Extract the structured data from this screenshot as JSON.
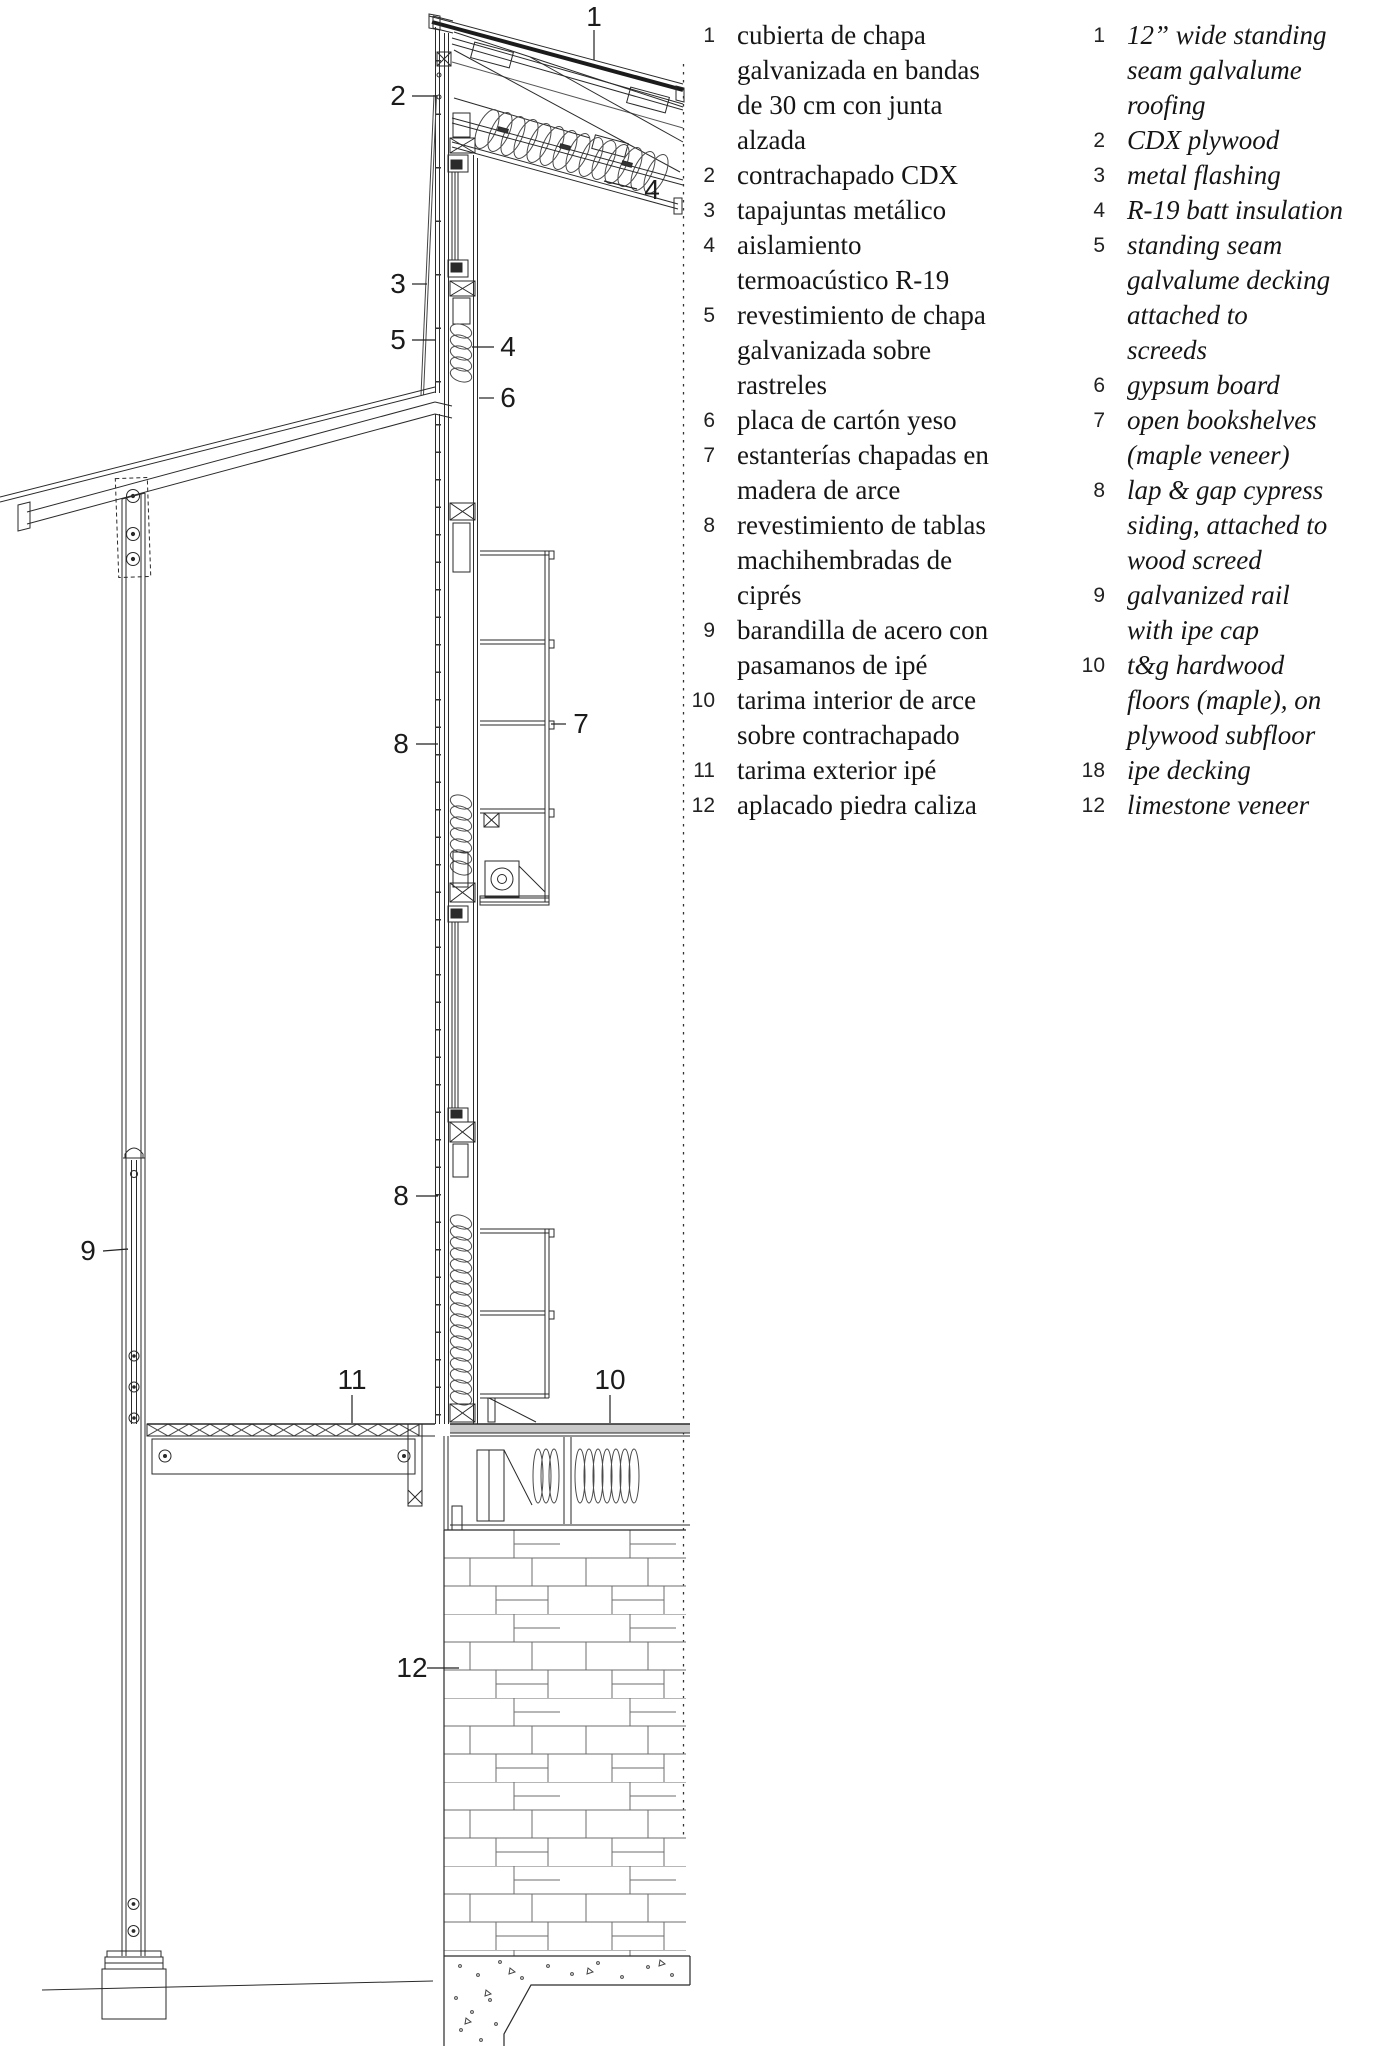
{
  "drawing": {
    "callouts": [
      {
        "n": "1",
        "x": 594,
        "y": 17
      },
      {
        "n": "2",
        "x": 398,
        "y": 96
      },
      {
        "n": "3",
        "x": 398,
        "y": 284
      },
      {
        "n": "5",
        "x": 398,
        "y": 340
      },
      {
        "n": "4",
        "x": 652,
        "y": 190
      },
      {
        "n": "4",
        "x": 508,
        "y": 347
      },
      {
        "n": "6",
        "x": 508,
        "y": 398
      },
      {
        "n": "7",
        "x": 581,
        "y": 724
      },
      {
        "n": "8",
        "x": 401,
        "y": 744
      },
      {
        "n": "8",
        "x": 401,
        "y": 1196
      },
      {
        "n": "9",
        "x": 88,
        "y": 1251
      },
      {
        "n": "11",
        "x": 352,
        "y": 1380
      },
      {
        "n": "10",
        "x": 610,
        "y": 1380
      },
      {
        "n": "12",
        "x": 412,
        "y": 1668
      }
    ]
  },
  "legend_es": {
    "items": [
      {
        "n": "1",
        "lines": [
          "cubierta de chapa",
          "galvanizada en bandas",
          "de 30 cm con junta",
          "alzada"
        ]
      },
      {
        "n": "2",
        "lines": [
          "contrachapado CDX"
        ]
      },
      {
        "n": "3",
        "lines": [
          "tapajuntas metálico"
        ]
      },
      {
        "n": "4",
        "lines": [
          "aislamiento",
          "termoacústico R-19"
        ]
      },
      {
        "n": "5",
        "lines": [
          "revestimiento de chapa",
          "galvanizada sobre",
          "rastreles"
        ]
      },
      {
        "n": "6",
        "lines": [
          "placa de cartón yeso"
        ]
      },
      {
        "n": "7",
        "lines": [
          "estanterías chapadas en",
          "madera de arce"
        ]
      },
      {
        "n": "8",
        "lines": [
          "revestimiento de tablas",
          "machihembradas de",
          "ciprés"
        ]
      },
      {
        "n": "9",
        "lines": [
          "barandilla de acero con",
          "pasamanos de ipé"
        ]
      },
      {
        "n": "10",
        "lines": [
          "tarima interior de arce",
          "sobre contrachapado"
        ]
      },
      {
        "n": "11",
        "lines": [
          "tarima exterior ipé"
        ]
      },
      {
        "n": "12",
        "lines": [
          "aplacado piedra caliza"
        ]
      }
    ]
  },
  "legend_en": {
    "items": [
      {
        "n": "1",
        "lines": [
          "12” wide standing",
          "seam galvalume",
          "roofing"
        ]
      },
      {
        "n": "2",
        "lines": [
          "CDX plywood"
        ]
      },
      {
        "n": "3",
        "lines": [
          "metal flashing"
        ]
      },
      {
        "n": "4",
        "lines": [
          "R-19 batt insulation"
        ]
      },
      {
        "n": "5",
        "lines": [
          "standing seam",
          "galvalume decking",
          "attached to",
          "screeds"
        ]
      },
      {
        "n": "6",
        "lines": [
          "gypsum board"
        ]
      },
      {
        "n": "7",
        "lines": [
          "open bookshelves",
          "(maple veneer)"
        ]
      },
      {
        "n": "8",
        "lines": [
          "lap & gap cypress",
          "siding, attached to",
          "wood screed"
        ]
      },
      {
        "n": "9",
        "lines": [
          "galvanized rail",
          "with ipe cap"
        ]
      },
      {
        "n": "10",
        "lines": [
          "t&g hardwood",
          "floors (maple), on",
          "plywood subfloor"
        ]
      },
      {
        "n": "18",
        "lines": [
          "ipe decking"
        ]
      },
      {
        "n": "12",
        "lines": [
          "limestone veneer"
        ]
      }
    ]
  },
  "colors": {
    "ink": "#1f1f1f",
    "light_ink": "#555555",
    "stone_line": "#6e6e6e",
    "floor_fill": "#c9c9c9"
  }
}
